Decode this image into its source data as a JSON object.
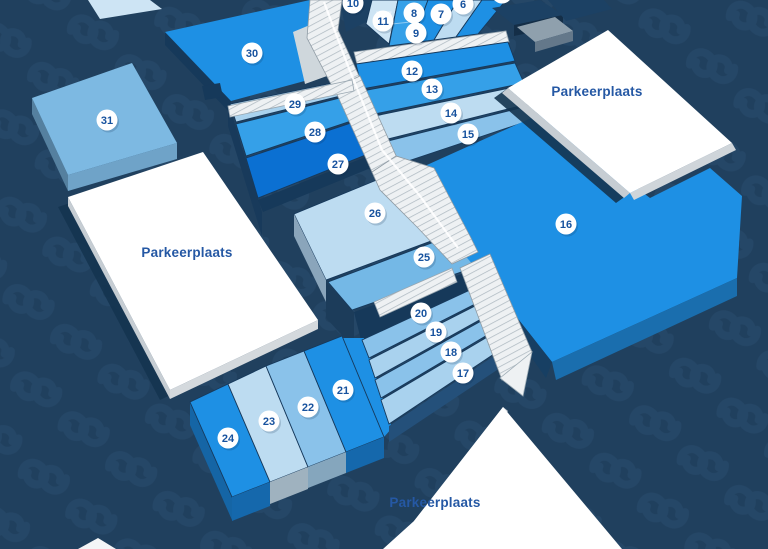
{
  "map_title": "Exhibition halls overview map",
  "palette": {
    "bright": "#1e90e4",
    "deep": "#0b70d2",
    "medium": "#35a0e8",
    "pale": "#bddcf1",
    "paleLight": "#cde4f4",
    "light": "#a9d2ee",
    "lightMed": "#8ac2ea",
    "lightMed2": "#74b8e6",
    "med31": "#7db9e2",
    "steel": "#8aa5bb",
    "navyBlock": "#1c4164",
    "grayBlock": "#8fa0ad",
    "background": "#20405e",
    "circleText": "#17529e",
    "lotLabel": "#2558a4",
    "white": "#ffffff"
  },
  "halls": [
    {
      "label": "6"
    },
    {
      "label": "7"
    },
    {
      "label": "8"
    },
    {
      "label": "9"
    },
    {
      "label": "10"
    },
    {
      "label": "11"
    },
    {
      "label": "12"
    },
    {
      "label": "13"
    },
    {
      "label": "14"
    },
    {
      "label": "15"
    },
    {
      "label": "16"
    },
    {
      "label": "17"
    },
    {
      "label": "18"
    },
    {
      "label": "19"
    },
    {
      "label": "20"
    },
    {
      "label": "21"
    },
    {
      "label": "22"
    },
    {
      "label": "23"
    },
    {
      "label": "24"
    },
    {
      "label": "25"
    },
    {
      "label": "26"
    },
    {
      "label": "27"
    },
    {
      "label": "28"
    },
    {
      "label": "29"
    },
    {
      "label": "30"
    },
    {
      "label": "31"
    }
  ],
  "lots": [
    {
      "label": "Parkeerplaats"
    },
    {
      "label": "Parkeerplaats"
    },
    {
      "label": "Parkeerplaats"
    }
  ]
}
